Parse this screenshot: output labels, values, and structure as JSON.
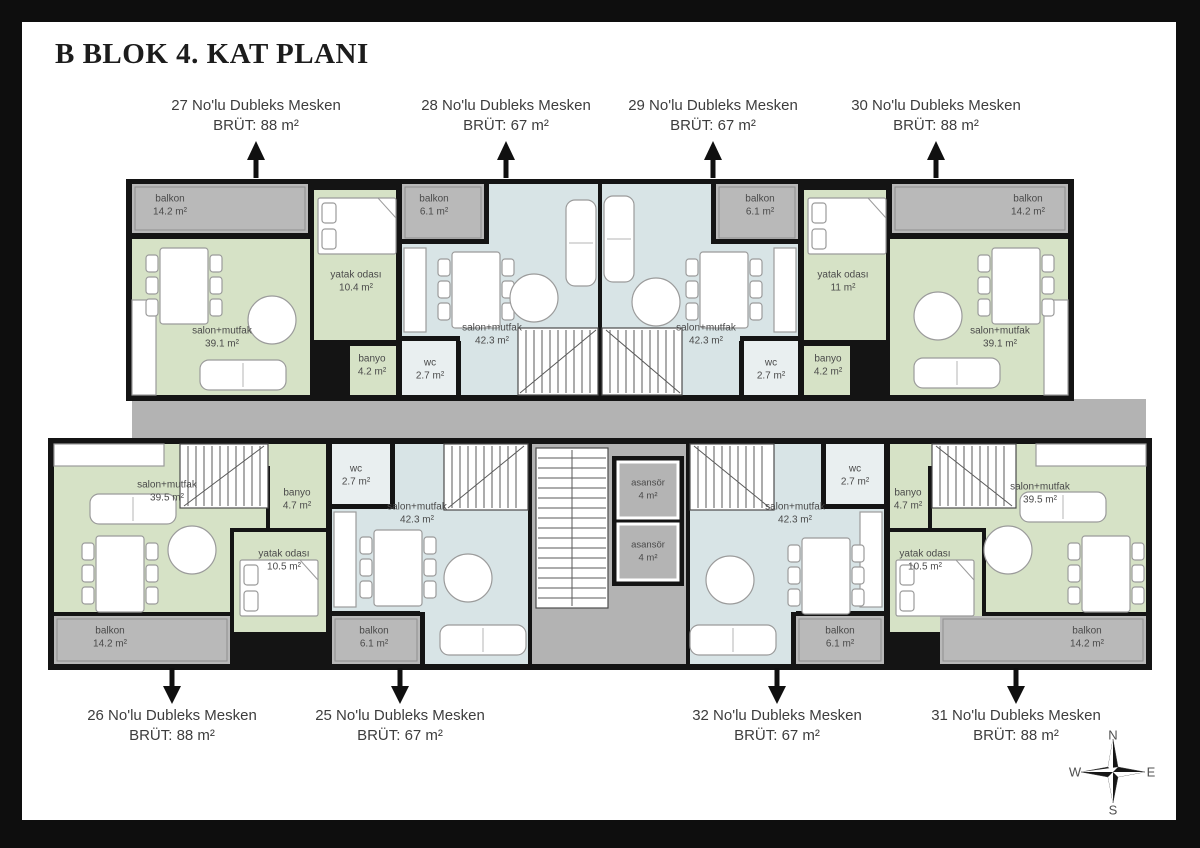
{
  "title": "B BLOK 4. KAT PLANI",
  "units": {
    "u27": {
      "name": "27 No'lu Dubleks Mesken",
      "area": "BRÜT: 88 m²"
    },
    "u28": {
      "name": "28 No'lu Dubleks Mesken",
      "area": "BRÜT: 67 m²"
    },
    "u29": {
      "name": "29 No'lu Dubleks Mesken",
      "area": "BRÜT: 67 m²"
    },
    "u30": {
      "name": "30 No'lu Dubleks Mesken",
      "area": "BRÜT: 88 m²"
    },
    "u26": {
      "name": "26 No'lu Dubleks Mesken",
      "area": "BRÜT: 88 m²"
    },
    "u25": {
      "name": "25 No'lu Dubleks Mesken",
      "area": "BRÜT: 67 m²"
    },
    "u32": {
      "name": "32 No'lu Dubleks Mesken",
      "area": "BRÜT: 67 m²"
    },
    "u31": {
      "name": "31 No'lu Dubleks Mesken",
      "area": "BRÜT: 88 m²"
    }
  },
  "rooms": {
    "u27_balkon": {
      "name": "balkon",
      "area": "14.2 m²"
    },
    "u27_salon": {
      "name": "salon+mutfak",
      "area": "39.1 m²"
    },
    "u27_yatak": {
      "name": "yatak odası",
      "area": "10.4 m²"
    },
    "u27_banyo": {
      "name": "banyo",
      "area": "4.2 m²"
    },
    "u28_balkon": {
      "name": "balkon",
      "area": "6.1 m²"
    },
    "u28_salon": {
      "name": "salon+mutfak",
      "area": "42.3 m²"
    },
    "u28_wc": {
      "name": "wc",
      "area": "2.7 m²"
    },
    "u29_balkon": {
      "name": "balkon",
      "area": "6.1 m²"
    },
    "u29_salon": {
      "name": "salon+mutfak",
      "area": "42.3 m²"
    },
    "u29_wc": {
      "name": "wc",
      "area": "2.7 m²"
    },
    "u30_balkon": {
      "name": "balkon",
      "area": "14.2 m²"
    },
    "u30_salon": {
      "name": "salon+mutfak",
      "area": "39.1 m²"
    },
    "u30_yatak": {
      "name": "yatak odası",
      "area": "11 m²"
    },
    "u30_banyo": {
      "name": "banyo",
      "area": "4.2 m²"
    },
    "u26_salon": {
      "name": "salon+mutfak",
      "area": "39.5 m²"
    },
    "u26_banyo": {
      "name": "banyo",
      "area": "4.7 m²"
    },
    "u26_yatak": {
      "name": "yatak odası",
      "area": "10.5 m²"
    },
    "u26_balkon": {
      "name": "balkon",
      "area": "14.2 m²"
    },
    "u25_wc": {
      "name": "wc",
      "area": "2.7 m²"
    },
    "u25_salon": {
      "name": "salon+mutfak",
      "area": "42.3 m²"
    },
    "u25_balkon": {
      "name": "balkon",
      "area": "6.1 m²"
    },
    "u32_wc": {
      "name": "wc",
      "area": "2.7 m²"
    },
    "u32_salon": {
      "name": "salon+mutfak",
      "area": "42.3 m²"
    },
    "u32_balkon": {
      "name": "balkon",
      "area": "6.1 m²"
    },
    "u31_banyo": {
      "name": "banyo",
      "area": "4.7 m²"
    },
    "u31_yatak": {
      "name": "yatak odası",
      "area": "10.5 m²"
    },
    "u31_salon": {
      "name": "salon+mutfak",
      "area": "39.5 m²"
    },
    "u31_balkon": {
      "name": "balkon",
      "area": "14.2 m²"
    }
  },
  "elevator": {
    "name": "asansör",
    "area": "4 m²"
  },
  "compass": {
    "n": "N",
    "e": "E",
    "s": "S",
    "w": "W"
  },
  "colors": {
    "room_green": "#d6e2c6",
    "room_blue": "#d8e4e6",
    "balcony_gray": "#b9b9b9",
    "corridor_gray": "#b3b3b3",
    "wall_black": "#141414",
    "paper_white": "#ffffff"
  }
}
